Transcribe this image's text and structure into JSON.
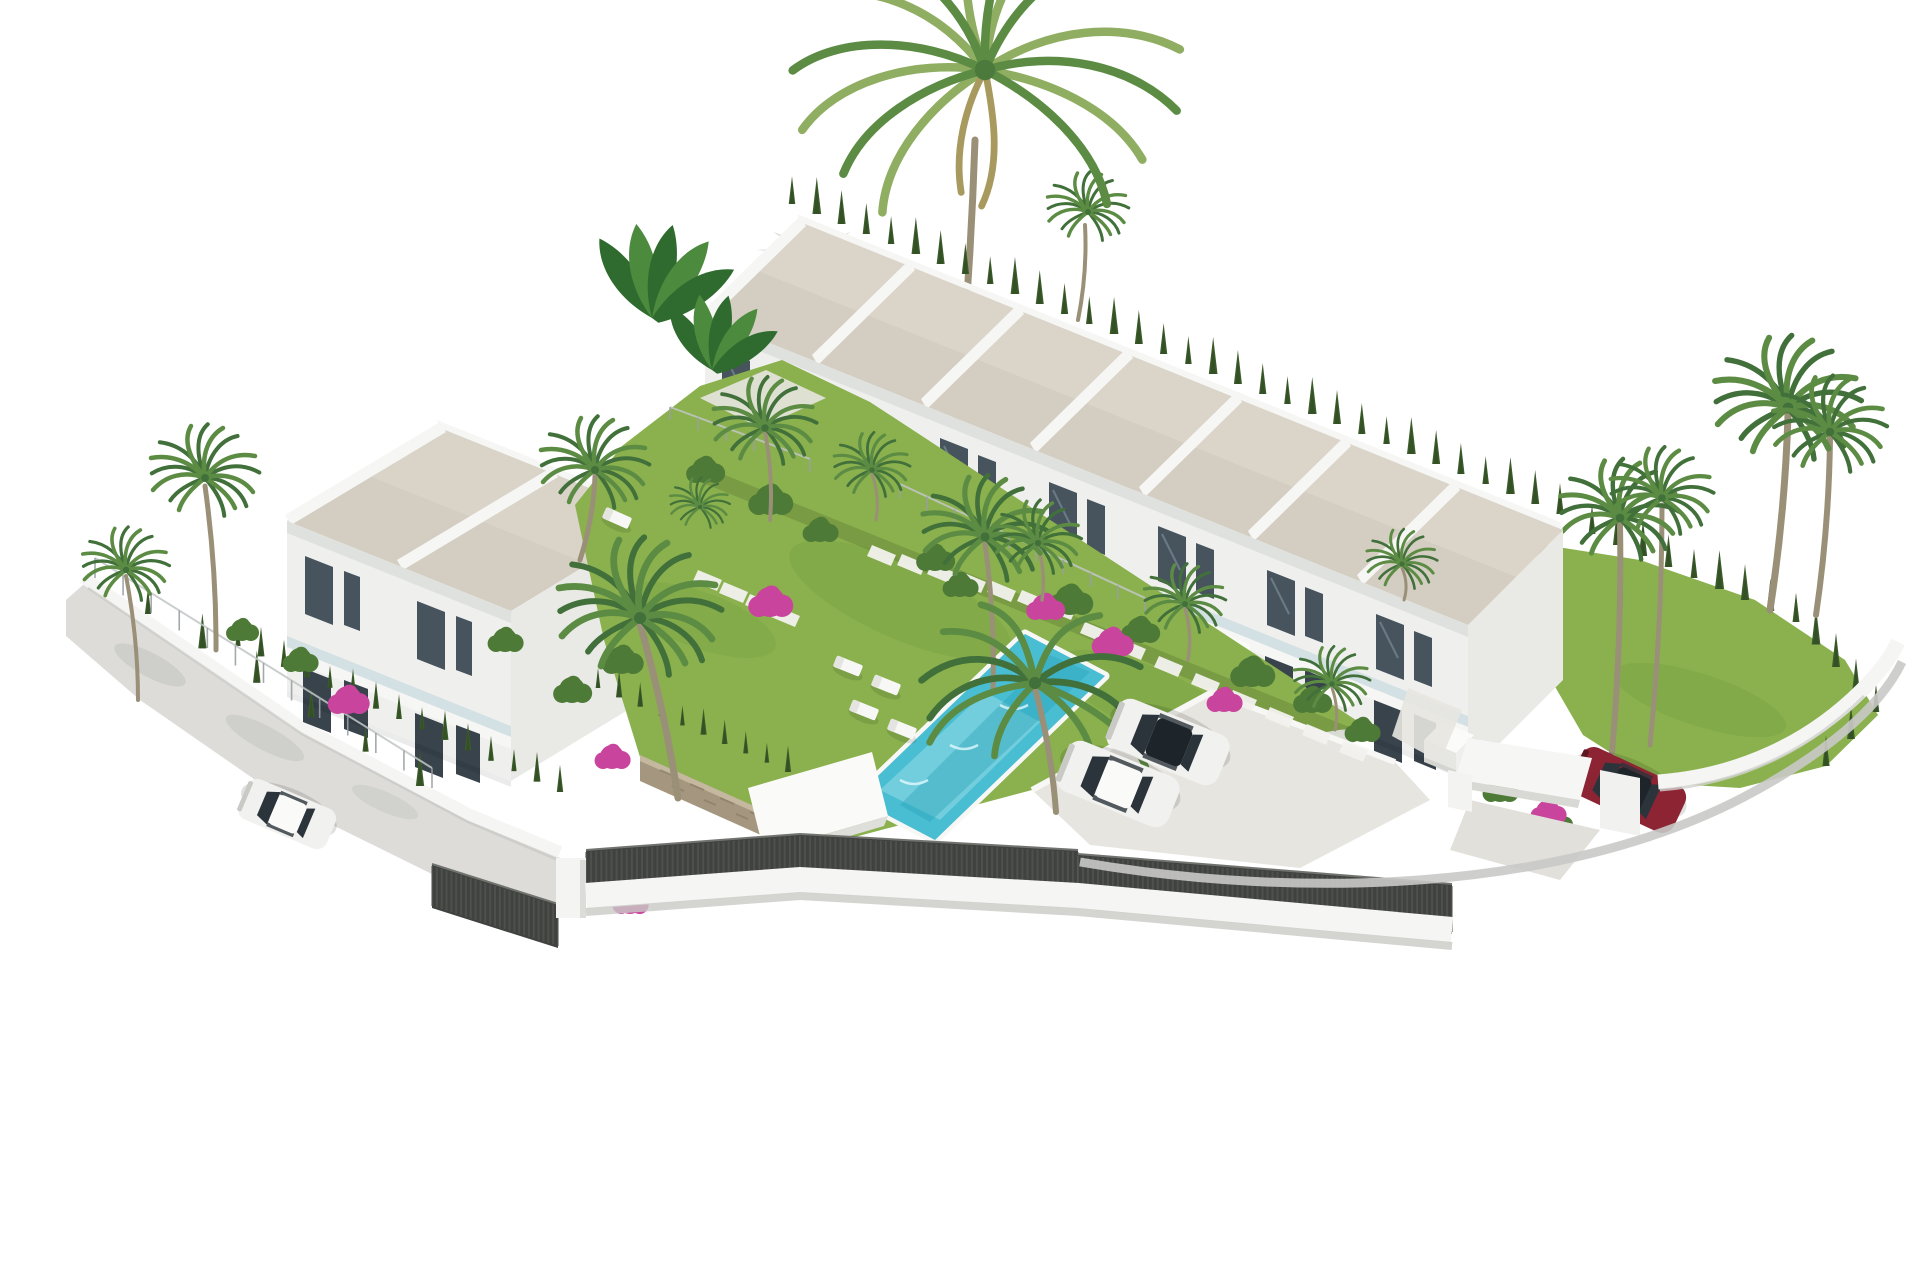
{
  "meta": {
    "type": "3d-architectural-render",
    "subject": "Aerial isometric render of a white townhouse development with communal pool, children's pool, palm gardens and parking",
    "width": 1920,
    "height": 1280
  },
  "colors": {
    "background": "#ffffff",
    "roof": "#d4cdc1",
    "parapet": "#f6f6f4",
    "facade": "#eff0ee",
    "facade_shade": "#dcdeda",
    "gable": "#f5f5f3",
    "gable_shade": "#e9e9e6",
    "glass": "#47545e",
    "glass_dark": "#38434c",
    "rail": "#b9d2da",
    "grass": "#8ab14d",
    "grass_dark": "#6f9c3f",
    "hedge": "#44632f",
    "cypress": "#3c5c2b",
    "bush_green": "#4e7a37",
    "palm": "#5c8c43",
    "palm_dark": "#41703a",
    "palm_light": "#8fae62",
    "trunk": "#9a9078",
    "banana": "#2f6b2f",
    "banana_light": "#4c8a3e",
    "water": "#49bdd2",
    "water_light": "#a5e2ec",
    "water_dark": "#2aa2b9",
    "kids_deck": "#aedae7",
    "kids_water": "#87d2e2",
    "paving": "#e7e5e0",
    "street": "#dddcd9",
    "curb": "#c9c9c6",
    "wall_white": "#f5f5f3",
    "wall_shadow": "#c6c6c3",
    "fence_dark": "#3f423e",
    "fence_slat": "#5a5d59",
    "car_white": "#f1f1ef",
    "car_red": "#8c2433",
    "car_glass": "#2c343b",
    "pink": "#c9449c",
    "stone": "#a5977f",
    "shadow": "#b4b8b3"
  },
  "inventory": {
    "townhouse_row_units": 7,
    "left_block_units": 2,
    "communal_pools": 1,
    "children_pools": 1,
    "white_cars": 3,
    "red_cars": 1,
    "swing_sets": 1,
    "sun_loungers": 5,
    "shade_sails": 2,
    "tall_fan_palms": 4
  },
  "layout": {
    "row": {
      "origin": [
        800,
        222
      ],
      "step": [
        109,
        44
      ],
      "units": 7
    },
    "left_block": {
      "origin": [
        440,
        428
      ],
      "step": [
        112,
        45
      ],
      "units": 2
    },
    "hedgerows": [
      {
        "from": [
          792,
          204
        ],
        "to": [
          1560,
          514
        ],
        "n": 32,
        "s": 1.0,
        "t": "back"
      },
      {
        "from": [
          1592,
          534
        ],
        "to": [
          1796,
          622
        ],
        "n": 9,
        "s": 1.05,
        "t": "right"
      },
      {
        "from": [
          1796,
          622
        ],
        "to": [
          1876,
          712
        ],
        "n": 5,
        "s": 1.0,
        "t": "right"
      },
      {
        "from": [
          1876,
          712
        ],
        "to": [
          1826,
          766
        ],
        "n": 3,
        "s": 0.9,
        "t": "right"
      },
      {
        "from": [
          238,
          646
        ],
        "to": [
          560,
          792
        ],
        "n": 15,
        "s": 0.8,
        "t": "front"
      },
      {
        "from": [
          598,
          688
        ],
        "to": [
          788,
          772
        ],
        "n": 10,
        "s": 0.72,
        "t": "front"
      },
      {
        "from": [
          148,
          614
        ],
        "to": [
          420,
          786
        ],
        "n": 6,
        "s": 0.95,
        "t": "front"
      }
    ],
    "wire_fences": [
      {
        "from": [
          95,
          578
        ],
        "to": [
          432,
          788
        ],
        "posts": 12,
        "h": 20
      },
      {
        "from": [
          900,
          498
        ],
        "to": [
          1145,
          612
        ],
        "posts": 9,
        "h": 14
      },
      {
        "from": [
          670,
          420
        ],
        "to": [
          810,
          472
        ],
        "posts": 5,
        "h": 13
      }
    ],
    "fence_segments": [
      [
        432,
        864,
        558,
        904,
        44
      ],
      [
        586,
        850,
        800,
        834,
        46
      ],
      [
        800,
        834,
        1078,
        850,
        48
      ],
      [
        1078,
        854,
        1452,
        884,
        50
      ]
    ],
    "stone_runs": [
      {
        "x": 1085,
        "y": 622,
        "dx": 37,
        "dy": 17,
        "n": 8
      },
      {
        "x": 872,
        "y": 545,
        "dx": 30,
        "dy": 9,
        "n": 7
      },
      {
        "x": 698,
        "y": 570,
        "dx": 26,
        "dy": 12,
        "n": 4
      }
    ],
    "loungers": [
      [
        848,
        666,
        22
      ],
      [
        886,
        685,
        22
      ],
      [
        864,
        710,
        22
      ],
      [
        902,
        729,
        22
      ],
      [
        617,
        518,
        24
      ]
    ],
    "fan_palms": [
      [
        205,
        478,
        1.0,
        "front"
      ],
      [
        126,
        570,
        0.8,
        "front"
      ],
      [
        595,
        470,
        1.0,
        "front"
      ],
      [
        640,
        618,
        1.5,
        "front"
      ],
      [
        700,
        507,
        0.55,
        "front"
      ],
      [
        985,
        537,
        1.15,
        "front"
      ],
      [
        765,
        428,
        0.95,
        "front"
      ],
      [
        872,
        470,
        0.7,
        "front"
      ],
      [
        1038,
        543,
        0.8,
        "front"
      ],
      [
        1185,
        604,
        0.75,
        "front"
      ],
      [
        1332,
        684,
        0.7,
        "front"
      ],
      [
        1402,
        564,
        0.65,
        "front"
      ],
      [
        1620,
        518,
        1.1,
        "right"
      ],
      [
        1662,
        498,
        0.95,
        "right"
      ],
      [
        1788,
        408,
        1.35,
        "right"
      ],
      [
        1830,
        432,
        1.05,
        "right"
      ],
      [
        1088,
        212,
        0.75,
        "back"
      ]
    ],
    "weeping_palms": [
      [
        1035,
        683,
        1.35
      ]
    ],
    "feather_palm": [
      985,
      70,
      1.7
    ],
    "trunks": [
      {
        "d": [
          975,
          140,
          952,
          470
        ],
        "w": 7,
        "t": "back"
      },
      {
        "d": [
          1085,
          225,
          1078,
          320
        ],
        "w": 4,
        "t": "back"
      },
      {
        "d": [
          1620,
          525,
          1612,
          752
        ],
        "w": 6,
        "t": "right"
      },
      {
        "d": [
          1662,
          505,
          1650,
          745
        ],
        "w": 5,
        "t": "right"
      },
      {
        "d": [
          1788,
          415,
          1770,
          610
        ],
        "w": 7,
        "t": "right"
      },
      {
        "d": [
          1830,
          438,
          1816,
          615
        ],
        "w": 6,
        "t": "right"
      },
      {
        "d": [
          205,
          486,
          216,
          650
        ],
        "w": 5,
        "t": "front"
      },
      {
        "d": [
          126,
          576,
          138,
          700
        ],
        "w": 4,
        "t": "front"
      },
      {
        "d": [
          595,
          476,
          580,
          560
        ],
        "w": 5,
        "t": "front"
      },
      {
        "d": [
          640,
          624,
          678,
          798
        ],
        "w": 7,
        "t": "front"
      },
      {
        "d": [
          985,
          543,
          993,
          690
        ],
        "w": 5,
        "t": "front"
      },
      {
        "d": [
          1035,
          688,
          1056,
          812
        ],
        "w": 6,
        "t": "front"
      },
      {
        "d": [
          765,
          432,
          770,
          520
        ],
        "w": 4,
        "t": "front"
      },
      {
        "d": [
          872,
          474,
          876,
          520
        ],
        "w": 3,
        "t": "front"
      },
      {
        "d": [
          1038,
          546,
          1042,
          600
        ],
        "w": 3.5,
        "t": "front"
      },
      {
        "d": [
          1185,
          608,
          1188,
          660
        ],
        "w": 3.5,
        "t": "front"
      },
      {
        "d": [
          1332,
          688,
          1335,
          730
        ],
        "w": 3,
        "t": "front"
      },
      {
        "d": [
          1402,
          568,
          1404,
          600
        ],
        "w": 3,
        "t": "front"
      }
    ],
    "bushes_green": [
      [
        705,
        470,
        13
      ],
      [
        770,
        500,
        15
      ],
      [
        935,
        558,
        13
      ],
      [
        1070,
        600,
        15
      ],
      [
        1140,
        630,
        13
      ],
      [
        1252,
        672,
        15
      ],
      [
        1312,
        700,
        13
      ],
      [
        1362,
        730,
        12
      ],
      [
        622,
        660,
        14
      ],
      [
        505,
        640,
        12
      ],
      [
        572,
        690,
        13
      ],
      [
        300,
        660,
        12
      ],
      [
        242,
        630,
        11
      ],
      [
        1500,
        790,
        12
      ],
      [
        1556,
        822,
        11
      ],
      [
        960,
        585,
        12
      ],
      [
        820,
        530,
        12
      ]
    ],
    "bushes_pink": [
      [
        770,
        602,
        15
      ],
      [
        1045,
        607,
        13
      ],
      [
        1112,
        642,
        14
      ],
      [
        1224,
        700,
        12
      ],
      [
        348,
        700,
        14
      ],
      [
        612,
        757,
        12
      ],
      [
        1548,
        812,
        12
      ],
      [
        630,
        902,
        12
      ]
    ],
    "banana": [
      [
        652,
        318,
        1.25
      ],
      [
        712,
        370,
        1.0
      ]
    ],
    "cars": [
      {
        "x": 1168,
        "y": 742,
        "r": 202,
        "s": 1.0,
        "body": "white",
        "roof": "dark"
      },
      {
        "x": 1118,
        "y": 784,
        "r": 202,
        "s": 1.0,
        "body": "white",
        "roof": "white"
      },
      {
        "x": 287,
        "y": 814,
        "r": 203,
        "s": 0.8,
        "body": "white",
        "roof": "white"
      },
      {
        "x": 1628,
        "y": 790,
        "r": 205,
        "s": 0.95,
        "body": "red",
        "roof": "dark"
      }
    ]
  }
}
